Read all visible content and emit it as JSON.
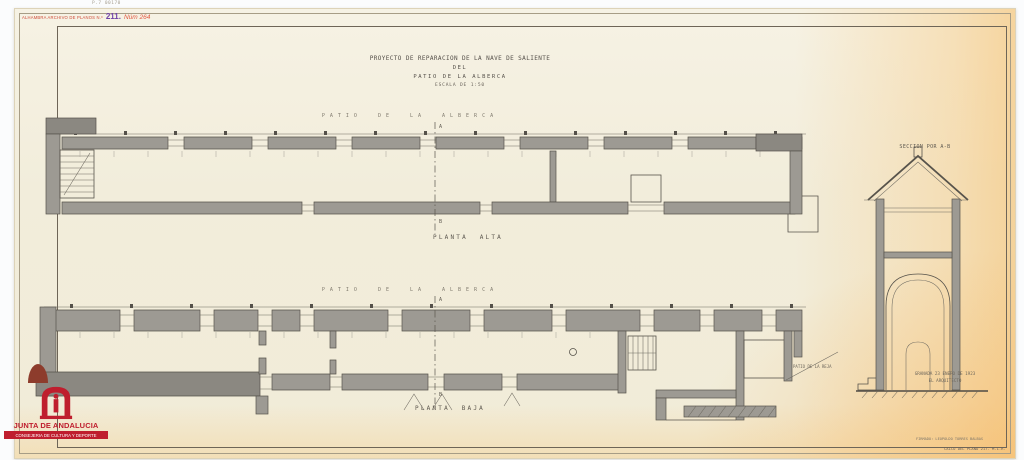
{
  "page": {
    "pencil_note": "P.7 00170"
  },
  "stamp": {
    "label": "ALHAMBRA ARCHIVO DE PLANOS N.º",
    "plan_number": "211.",
    "handwritten_number": "Núm 264"
  },
  "title_block": {
    "line1": "PROYECTO DE REPARACION DE LA NAVE DE SALIENTE",
    "line2": "DEL",
    "line3": "PATIO DE LA ALBERCA",
    "scale": "ESCALA DE 1:50"
  },
  "upper_plan": {
    "patio_label": "PATIO DE LA ALBERCA",
    "caption": "PLANTA ALTA",
    "section_marker_top": "A",
    "section_marker_bottom": "B"
  },
  "lower_plan": {
    "patio_label": "PATIO DE LA ALBERCA",
    "caption": "PLANTA BAJA",
    "section_marker_top": "A",
    "section_marker_bottom": "B",
    "patio_reja_label": "PATIO DE LA REJA"
  },
  "section_view": {
    "caption": "SECCION POR A-B"
  },
  "signature_block": {
    "line1": "GRANADA 23 ENERO DE 1923",
    "line2": "EL ARQUITECTO"
  },
  "footer": {
    "signed_note": "FIRMADO: LEOPOLDO TORRES BALBAS",
    "catalog_note": "CALCO DEL PLANO 217. M.L.R."
  },
  "archive_logo": {
    "org": "JUNTA DE ANDALUCIA",
    "dept": "CONSEJERIA DE CULTURA Y DEPORTE"
  },
  "colors": {
    "paper": "#f2edda",
    "paper_aged": "#f6c170",
    "ink": "#55504a",
    "wall_fill": "#9d9a93",
    "stamp_red": "#cf4a38",
    "stamp_purple": "#6f42a8",
    "logo_red": "#bf1e2e"
  }
}
